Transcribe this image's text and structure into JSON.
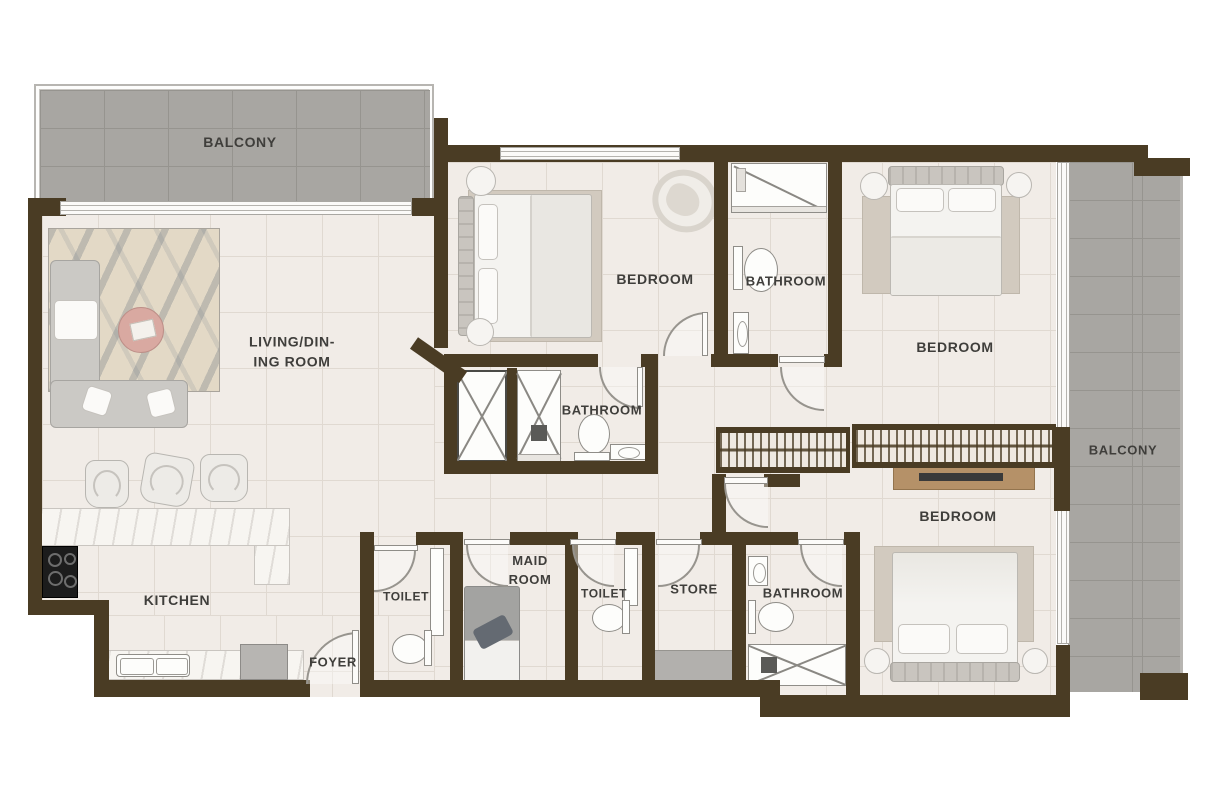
{
  "plan": {
    "type": "apartment-floor-plan",
    "colors": {
      "wall": "#4a3c24",
      "floor": "#f1ece7",
      "floor_line": "#e0d9d1",
      "balcony_tile": "#a8a6a2",
      "balcony_line": "#96948f",
      "label_text": "#3f3e3b",
      "accent_wood": "#b59168",
      "counter": "#f7f5f1"
    },
    "rooms": {
      "balcony_top": {
        "label": "BALCONY"
      },
      "living_dining": {
        "line1": "LIVING/DIN-",
        "line2": "ING ROOM"
      },
      "bedroom_top": {
        "label": "BEDROOM"
      },
      "bathroom_top": {
        "label": "BATHROOM"
      },
      "bathroom_mid": {
        "label": "BATHROOM"
      },
      "bedroom_right": {
        "label": "BEDROOM"
      },
      "balcony_right": {
        "label": "BALCONY"
      },
      "bedroom_bottom": {
        "label": "BEDROOM"
      },
      "kitchen": {
        "label": "KITCHEN"
      },
      "foyer": {
        "label": "FOYER"
      },
      "toilet_left": {
        "label": "TOILET"
      },
      "maid_room": {
        "line1": "MAID",
        "line2": "ROOM"
      },
      "toilet_right": {
        "label": "TOILET"
      },
      "store": {
        "label": "STORE"
      },
      "bathroom_bottom": {
        "label": "BATHROOM"
      }
    }
  }
}
